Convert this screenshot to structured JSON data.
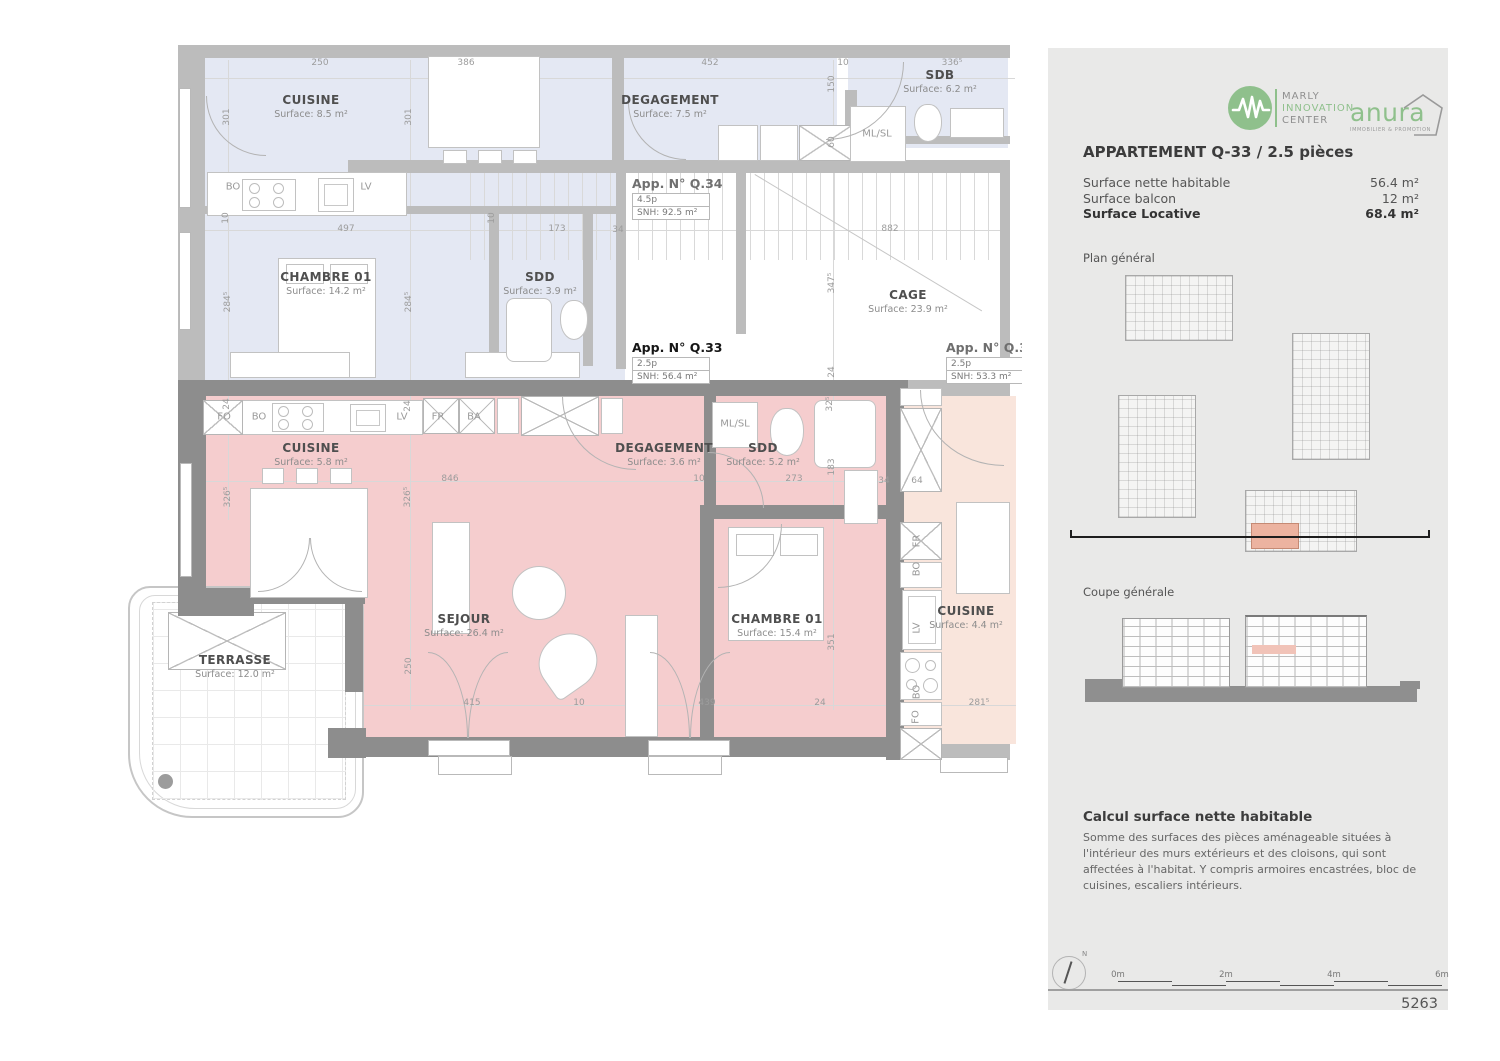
{
  "plan": {
    "colors": {
      "q33_pink": "#f5cdce",
      "q34_blue": "#e4e8f3",
      "neighbor_peach": "#f9e5dc",
      "wall_dark": "#8d8d8d",
      "wall_light": "#bcbcbc"
    },
    "rooms": [
      {
        "name": "CUISINE",
        "surface": "Surface: 8.5 m²",
        "x": 311,
        "y": 93
      },
      {
        "name": "DEGAGEMENT",
        "surface": "Surface: 7.5 m²",
        "x": 670,
        "y": 93
      },
      {
        "name": "SDB",
        "surface": "Surface: 6.2 m²",
        "x": 940,
        "y": 68
      },
      {
        "name": "CHAMBRE 01",
        "surface": "Surface: 14.2 m²",
        "x": 326,
        "y": 270
      },
      {
        "name": "SDD",
        "surface": "Surface: 3.9 m²",
        "x": 540,
        "y": 270
      },
      {
        "name": "CAGE",
        "surface": "Surface: 23.9 m²",
        "x": 908,
        "y": 288
      },
      {
        "name": "CUISINE",
        "surface": "Surface: 5.8 m²",
        "x": 311,
        "y": 441
      },
      {
        "name": "DEGAGEMENT",
        "surface": "Surface: 3.6 m²",
        "x": 664,
        "y": 441
      },
      {
        "name": "SDD",
        "surface": "Surface: 5.2 m²",
        "x": 763,
        "y": 441
      },
      {
        "name": "SEJOUR",
        "surface": "Surface: 26.4 m²",
        "x": 464,
        "y": 612
      },
      {
        "name": "CHAMBRE 01",
        "surface": "Surface: 15.4 m²",
        "x": 777,
        "y": 612
      },
      {
        "name": "CUISINE",
        "surface": "Surface: 4.4 m²",
        "x": 966,
        "y": 604
      },
      {
        "name": "TERRASSE",
        "surface": "Surface: 12.0 m²",
        "x": 235,
        "y": 653
      }
    ],
    "apartments": [
      {
        "title": "App. N° Q.34",
        "rows": [
          "4.5p",
          "SNH: 92.5 m²"
        ],
        "x": 632,
        "y": 176
      },
      {
        "title": "App. N° Q.33",
        "rows": [
          "2.5p",
          "SNH: 56.4 m²"
        ],
        "x": 632,
        "y": 340,
        "emph": true
      },
      {
        "title": "App. N° Q.3",
        "rows": [
          "2.5p",
          "SNH: 53.3 m²"
        ],
        "x": 946,
        "y": 340
      }
    ],
    "appliances": [
      {
        "t": "BO",
        "x": 233,
        "y": 187
      },
      {
        "t": "LV",
        "x": 366,
        "y": 187
      },
      {
        "t": "ML/SL",
        "x": 877,
        "y": 134
      },
      {
        "t": "FO",
        "x": 224,
        "y": 417
      },
      {
        "t": "BO",
        "x": 259,
        "y": 417
      },
      {
        "t": "LV",
        "x": 402,
        "y": 417
      },
      {
        "t": "FR",
        "x": 438,
        "y": 417
      },
      {
        "t": "BA",
        "x": 474,
        "y": 417
      },
      {
        "t": "ML/SL",
        "x": 735,
        "y": 424
      },
      {
        "t": "FR",
        "x": 917,
        "y": 541,
        "rot": 1
      },
      {
        "t": "BO",
        "x": 917,
        "y": 569,
        "rot": 1
      },
      {
        "t": "LV",
        "x": 917,
        "y": 628,
        "rot": 1
      },
      {
        "t": "BO",
        "x": 917,
        "y": 692,
        "rot": 1
      },
      {
        "t": "FO",
        "x": 916,
        "y": 717,
        "rot": 1
      }
    ],
    "dims": [
      {
        "t": "250",
        "x": 320,
        "y": 63
      },
      {
        "t": "386",
        "x": 466,
        "y": 63
      },
      {
        "t": "452",
        "x": 710,
        "y": 63
      },
      {
        "t": "10",
        "x": 843,
        "y": 63
      },
      {
        "t": "336⁵",
        "x": 952,
        "y": 63
      },
      {
        "t": "301",
        "x": 227,
        "y": 117,
        "rot": 1
      },
      {
        "t": "301",
        "x": 409,
        "y": 117,
        "rot": 1
      },
      {
        "t": "150",
        "x": 832,
        "y": 84,
        "rot": 1
      },
      {
        "t": "60",
        "x": 832,
        "y": 142,
        "rot": 1
      },
      {
        "t": "10",
        "x": 226,
        "y": 218,
        "rot": 1
      },
      {
        "t": "497",
        "x": 346,
        "y": 229
      },
      {
        "t": "10",
        "x": 492,
        "y": 218,
        "rot": 1
      },
      {
        "t": "173",
        "x": 557,
        "y": 229
      },
      {
        "t": "34",
        "x": 618,
        "y": 230
      },
      {
        "t": "882",
        "x": 890,
        "y": 229
      },
      {
        "t": "284⁵",
        "x": 228,
        "y": 302,
        "rot": 1
      },
      {
        "t": "284⁵",
        "x": 409,
        "y": 302,
        "rot": 1
      },
      {
        "t": "347⁵",
        "x": 832,
        "y": 283,
        "rot": 1
      },
      {
        "t": "24",
        "x": 832,
        "y": 372,
        "rot": 1
      },
      {
        "t": "24",
        "x": 227,
        "y": 404,
        "rot": 1
      },
      {
        "t": "24",
        "x": 408,
        "y": 406,
        "rot": 1
      },
      {
        "t": "846",
        "x": 450,
        "y": 479
      },
      {
        "t": "10",
        "x": 699,
        "y": 479
      },
      {
        "t": "273",
        "x": 794,
        "y": 479
      },
      {
        "t": "34",
        "x": 884,
        "y": 481
      },
      {
        "t": "64",
        "x": 917,
        "y": 481
      },
      {
        "t": "326⁵",
        "x": 228,
        "y": 497,
        "rot": 1
      },
      {
        "t": "326⁵",
        "x": 408,
        "y": 497,
        "rot": 1
      },
      {
        "t": "32⁵",
        "x": 830,
        "y": 404,
        "rot": 1
      },
      {
        "t": "183",
        "x": 832,
        "y": 467,
        "rot": 1
      },
      {
        "t": "250",
        "x": 409,
        "y": 666,
        "rot": 1
      },
      {
        "t": "351",
        "x": 832,
        "y": 642,
        "rot": 1
      },
      {
        "t": "415",
        "x": 472,
        "y": 703
      },
      {
        "t": "10",
        "x": 579,
        "y": 703
      },
      {
        "t": "439",
        "x": 707,
        "y": 703
      },
      {
        "t": "24",
        "x": 820,
        "y": 703
      },
      {
        "t": "281⁵",
        "x": 979,
        "y": 703
      }
    ]
  },
  "panel": {
    "logo_mic": {
      "lines": [
        "MARLY",
        "INNOVATION",
        "CENTER"
      ]
    },
    "logo_anura": {
      "name": "anura",
      "tagline": "IMMOBILIER & PROMOTION"
    },
    "title": "APPARTEMENT Q-33 / 2.5 pièces",
    "surfaces": [
      {
        "label": "Surface nette habitable",
        "value": "56.4 m²"
      },
      {
        "label": "Surface balcon",
        "value": "12 m²"
      },
      {
        "label": "Surface Locative",
        "value": "68.4 m²",
        "bold": true
      }
    ],
    "plan_general_label": "Plan général",
    "coupe_generale_label": "Coupe générale",
    "calcul_heading": "Calcul surface nette habitable",
    "calcul_body": "Somme des surfaces des pièces aménageable situées à l'intérieur des murs extérieurs et des cloisons, qui sont affectées à l'habitat. Y compris armoires encastrées, bloc de cuisines, escaliers intérieurs.",
    "north_label": "N",
    "scale_labels": [
      {
        "t": "0m",
        "x": 0
      },
      {
        "t": "2m",
        "x": 108
      },
      {
        "t": "4m",
        "x": 216
      },
      {
        "t": "6m",
        "x": 324
      }
    ],
    "sheet_number": "5263",
    "colors": {
      "accent_green": "#8fc08c",
      "highlight_salmon": "#ecb3a0"
    }
  }
}
